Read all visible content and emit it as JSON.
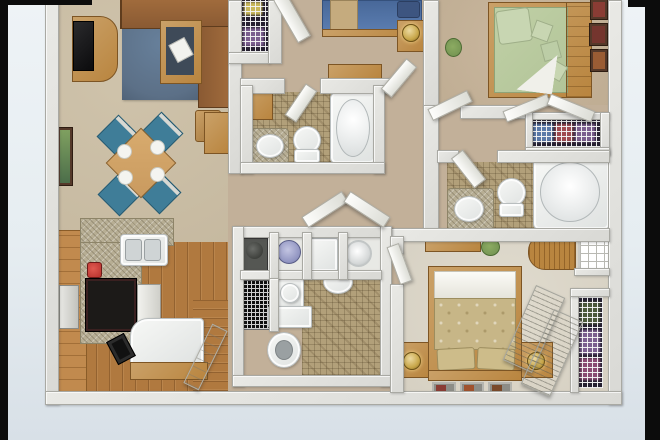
{
  "scene": {
    "kind": "3d-floorplan-render",
    "view": "top-down dollhouse view",
    "title": "Two-bath multi-bedroom apartment 3D floor plan",
    "visible_text": "none"
  },
  "colors": {
    "black": "#0c0c0c",
    "bgTop": "#eef3f6",
    "bgMid": "#e6edf1",
    "bgBottom": "#d8e0e7",
    "wall": "#d9d9d5",
    "wallEdge": "#a9a9a3",
    "carpetLiving": "#c6b9a0",
    "carpetHall": "#c2b099",
    "carpetBed3": "#bfad93",
    "carpetBed4": "#d6d0c2",
    "woodFloor": "#b0793f",
    "woodCabinet": "#c18a4e",
    "woodFurniture": "#b9853f",
    "granite": "#b7ae94",
    "tile": "#b2a07a",
    "rug": "#5c7087",
    "sofa": "#8a5a33",
    "chairTeal": "#3f7d98",
    "tableWood": "#c99a5f",
    "bedBlue": "#5b7db0",
    "bedTanBand": "#c5ab7e",
    "bedGreen": "#b2c498",
    "bedGreenPillow": "#c8d6b2",
    "bedGold": "#c7b687",
    "lampGold": "#c9a84c",
    "clothesPurple": "#7b5e8e",
    "clothesBlue": "#5a79a8",
    "clothesRed": "#a04a50",
    "clothesYellow": "#c8b75a",
    "plant": "#6f8f4f",
    "frameDark": "#55392a",
    "artRed": "#8a3c34",
    "cooktop": "#1c1a18",
    "applianceRed": "#b5302c"
  },
  "rooms": [
    {
      "id": "living-room",
      "label": "Living room: sectional sofa, TV console, coffee table, blue rug, wall art"
    },
    {
      "id": "dining-area",
      "label": "Dining area: square table, 4 teal chairs, 4 place settings, console table"
    },
    {
      "id": "kitchen",
      "label": "Kitchen: L granite counter, double sink, cooktop, coffee maker, breakfast bench"
    },
    {
      "id": "entry",
      "label": "Entry with open front door"
    },
    {
      "id": "bedroom-blue",
      "label": "Bedroom with blue bed, nightstand with lamp, dresser, wire-shelf closet"
    },
    {
      "id": "bathroom-1",
      "label": "Bathroom 1: vanity sink, toilet, bathtub, mosaic tile"
    },
    {
      "id": "hallway",
      "label": "Hallway with bifold laundry-closet doors"
    },
    {
      "id": "utility-bath",
      "label": "Utility block: water heater, washer, dryer, vent, powder sink, toilet"
    },
    {
      "id": "bedroom-green",
      "label": "Bedroom with green bed, throw pillows, picture frames, plant"
    },
    {
      "id": "closet-linen",
      "label": "Linen closet with wire shelf and clothes"
    },
    {
      "id": "bathroom-2",
      "label": "Bathroom 2: vanity sink, toilet, large oval tub"
    },
    {
      "id": "bedroom-gold",
      "label": "Bedroom with gold bed, two nightstands with lamps, wall frames, louvered closet, window"
    }
  ]
}
